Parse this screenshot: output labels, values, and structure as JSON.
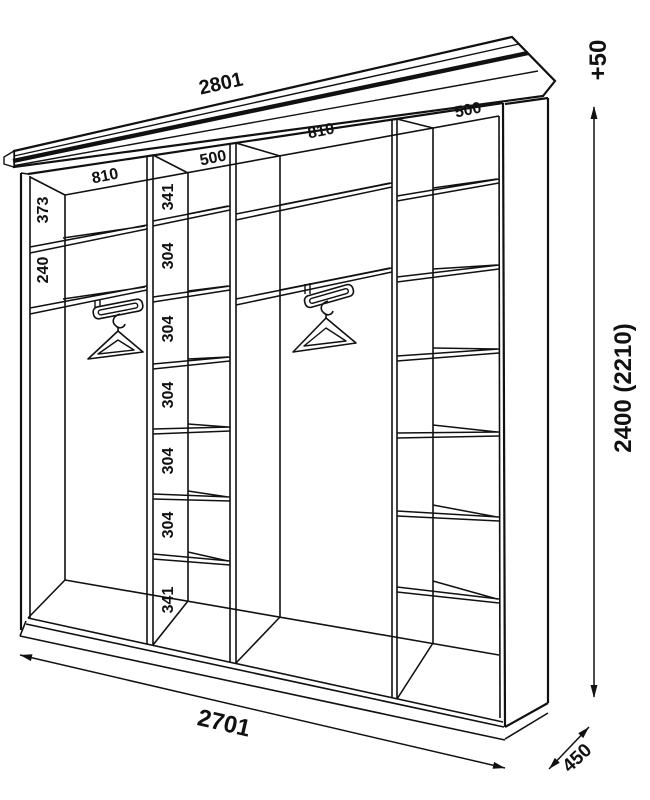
{
  "diagram": {
    "dims": {
      "top_width": "2801",
      "crown_extra": "+50",
      "height": "2400 (2210)",
      "bottom_width": "2701",
      "depth": "450"
    },
    "sections": {
      "labels": [
        "810",
        "500",
        "810",
        "500"
      ]
    },
    "left_section": {
      "heights": [
        "373",
        "240"
      ]
    },
    "shelf_column": {
      "heights": [
        "341",
        "304",
        "304",
        "304",
        "304",
        "304",
        "341"
      ]
    },
    "colors": {
      "line": "#111111",
      "background": "#ffffff",
      "hanger_fill": "#e3e3e3"
    }
  }
}
